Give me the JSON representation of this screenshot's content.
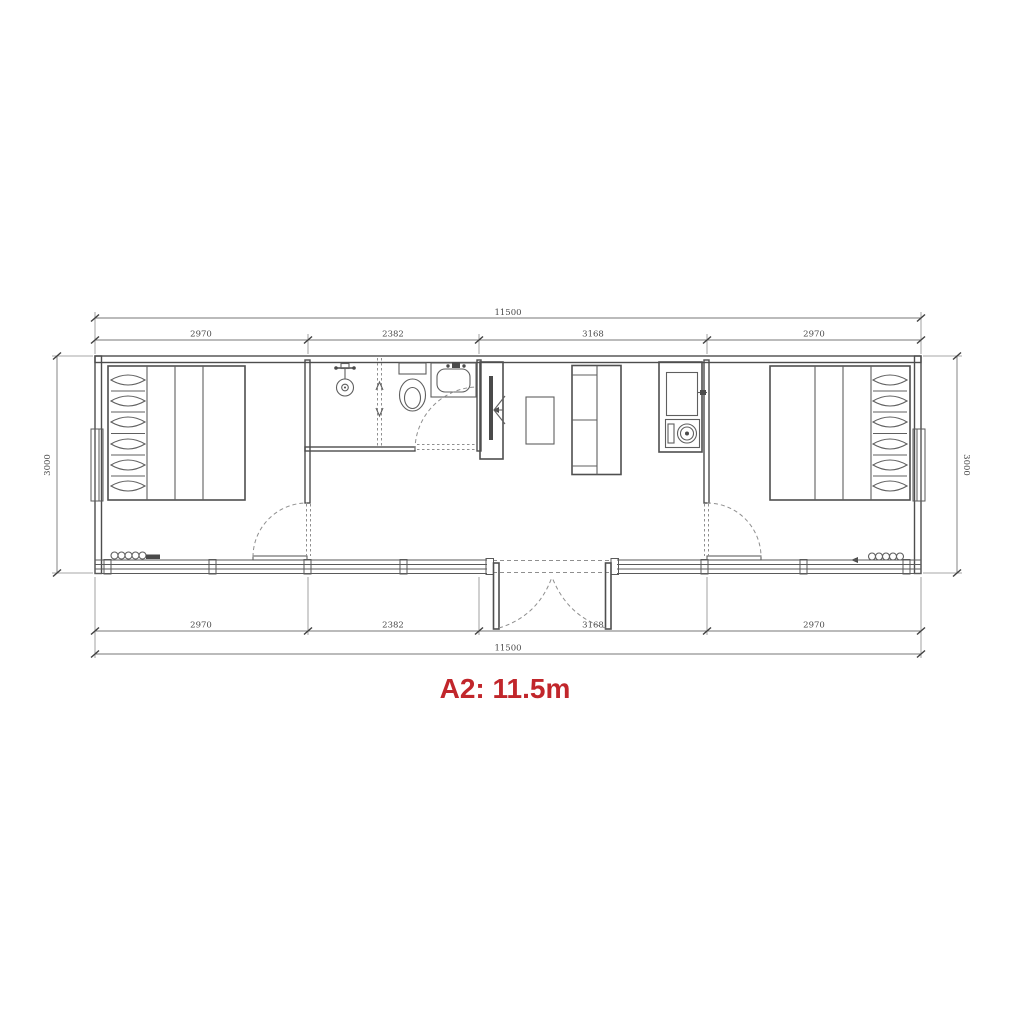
{
  "caption": {
    "text": "A2: 11.5m",
    "color": "#c1262b"
  },
  "dimensions": {
    "top": {
      "total": "11500",
      "segments": [
        "2970",
        "2382",
        "3168",
        "2970"
      ]
    },
    "bottom": {
      "total": "11500",
      "segments": [
        "2970",
        "2382",
        "3168",
        "2970"
      ]
    },
    "left": {
      "total": "3000"
    },
    "right": {
      "total": "3000"
    }
  },
  "palette": {
    "wall_line": "#4d4d4d",
    "furniture_line": "#5f5f5f",
    "dimension_line": "#777777",
    "dashed_line": "#8f8f8f",
    "accent_red": "#c1262b",
    "background": "#ffffff"
  },
  "fixtures": [
    "double-bed-left",
    "double-bed-right",
    "shower",
    "shower-screen",
    "toilet",
    "bathroom-sink",
    "tv-cabinet",
    "coffee-table",
    "sofa",
    "kitchen-sink",
    "cooktop",
    "entrance-double-door",
    "bedroom-door-left",
    "bedroom-door-right",
    "bathroom-door",
    "window-left",
    "window-right",
    "window-band-bottom",
    "radiator-left",
    "radiator-right"
  ]
}
